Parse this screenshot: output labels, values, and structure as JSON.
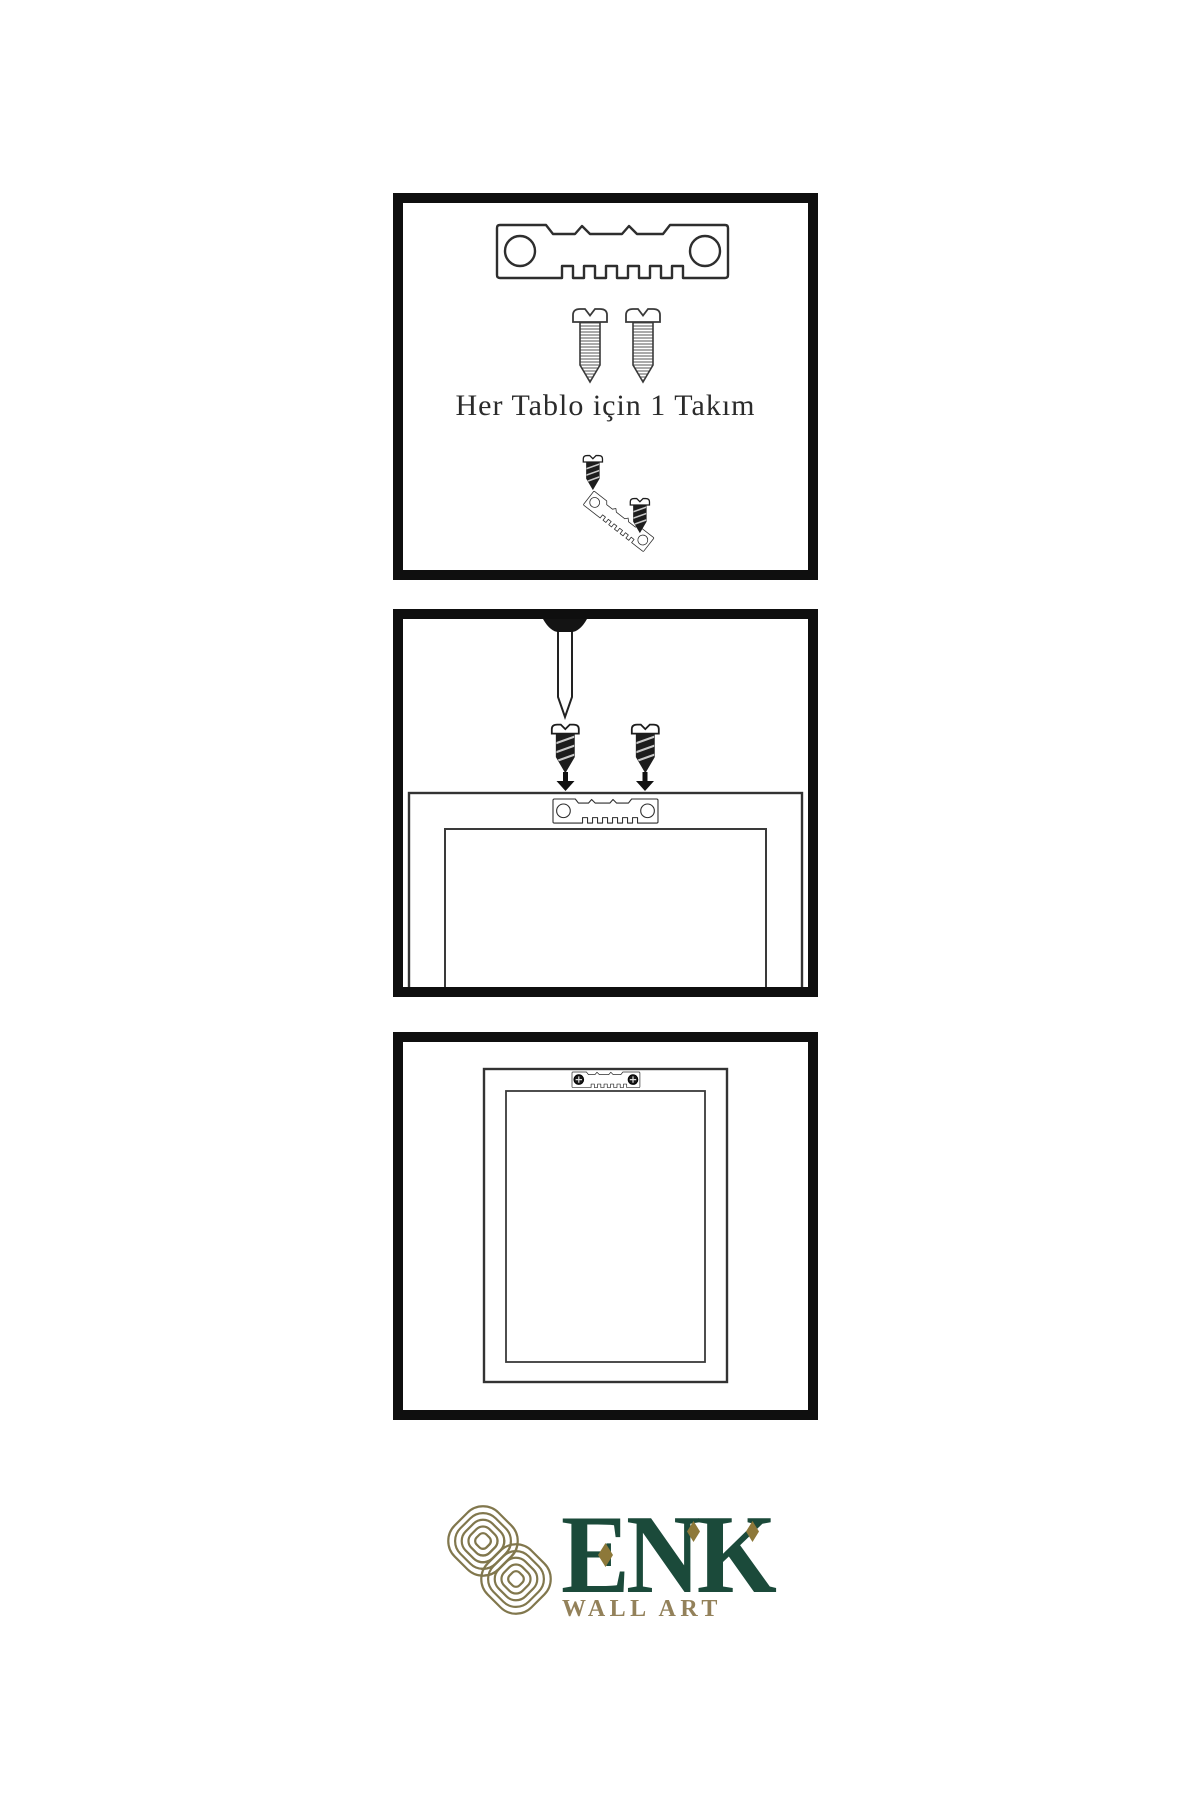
{
  "page": {
    "background": "#ffffff"
  },
  "colors": {
    "line": "#2e2e2e",
    "panel_border": "#0f0f0f",
    "screw_dark": "#1d1d1d",
    "knot_gold": "#81774d",
    "brand_green": "#1b4a3a",
    "tagline_gold": "#93815a",
    "diamond_gold": "#8d7839"
  },
  "panels": [
    {
      "name": "hardware-kit",
      "caption": "Her Tablo için 1 Takım",
      "items": [
        "sawtooth-hanger",
        "mounting-screw",
        "mounting-screw",
        "screw-driven-into-hanger"
      ]
    },
    {
      "name": "wall-nail-and-screws",
      "items": [
        "wall-nail",
        "screw-with-down-arrow",
        "screw-with-down-arrow",
        "frame-back-with-sawtooth-hanger"
      ]
    },
    {
      "name": "mounted-frame-back",
      "items": [
        "frame-back",
        "sawtooth-hanger-with-screws"
      ]
    }
  ],
  "logo": {
    "brand": "ENK",
    "tagline": "WALL ART"
  }
}
